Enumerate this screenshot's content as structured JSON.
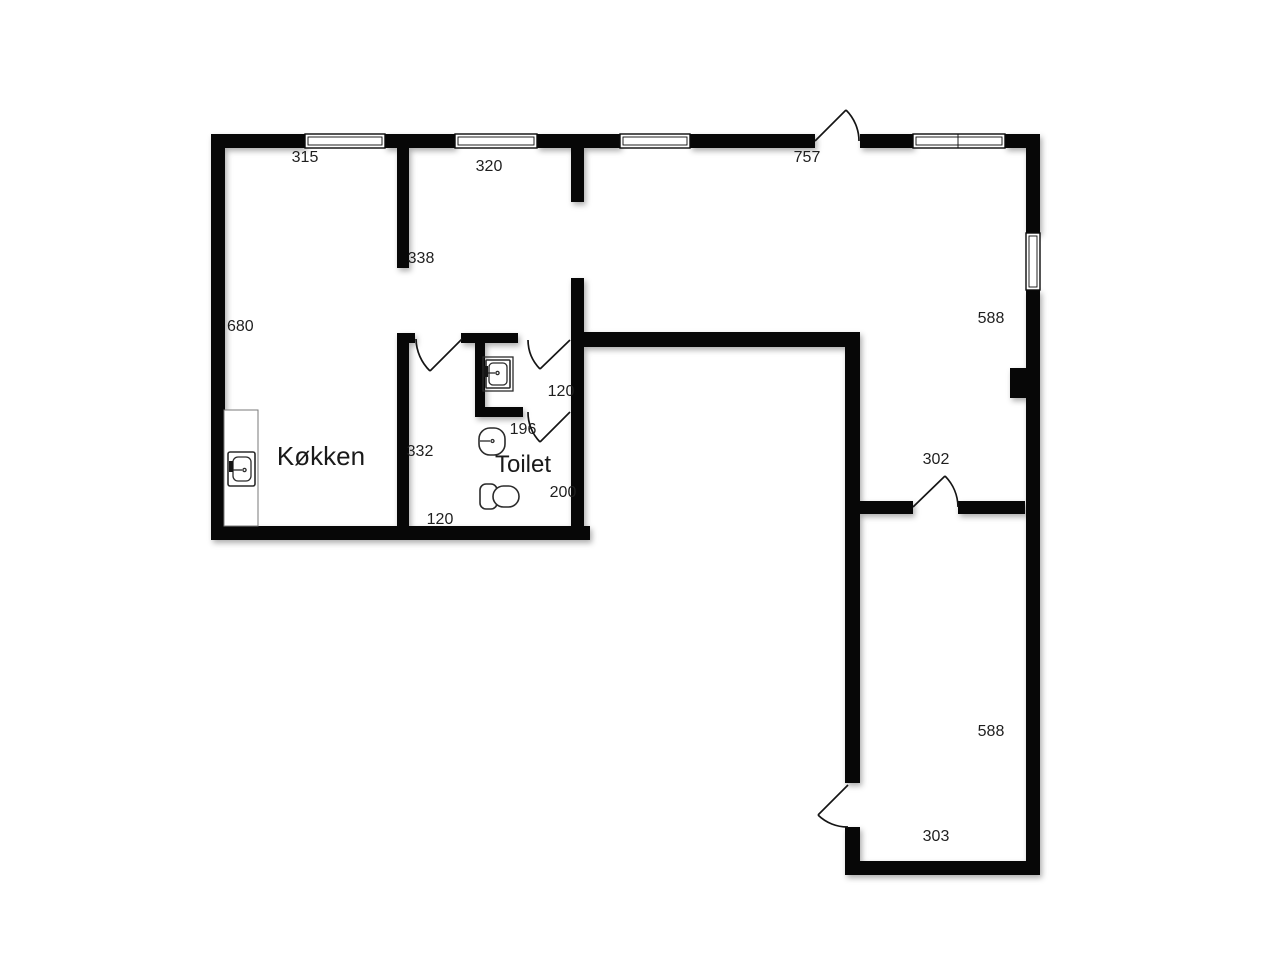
{
  "meta": {
    "type": "floor-plan",
    "language": "da"
  },
  "palette": {
    "wall": "#070707",
    "background": "#ffffff",
    "text": "#1f1f1f",
    "fixture_stroke": "#2b2b2b"
  },
  "rooms": [
    {
      "id": "kitchen",
      "label": "Køkken"
    },
    {
      "id": "toilet",
      "label": "Toilet"
    }
  ],
  "dimensions": [
    {
      "id": "top-left-width",
      "value": "315"
    },
    {
      "id": "top-mid-width",
      "value": "320"
    },
    {
      "id": "top-right-width",
      "value": "757"
    },
    {
      "id": "partition-length",
      "value": "338"
    },
    {
      "id": "left-side-height",
      "value": "680"
    },
    {
      "id": "right-upper-height",
      "value": "588"
    },
    {
      "id": "niche-width",
      "value": "120"
    },
    {
      "id": "toilet-door-width",
      "value": "196"
    },
    {
      "id": "hall-length",
      "value": "332"
    },
    {
      "id": "toilet-room-width",
      "value": "200"
    },
    {
      "id": "hall-width",
      "value": "120"
    },
    {
      "id": "wing-door-width",
      "value": "302"
    },
    {
      "id": "wing-height",
      "value": "588"
    },
    {
      "id": "wing-width",
      "value": "303"
    }
  ]
}
